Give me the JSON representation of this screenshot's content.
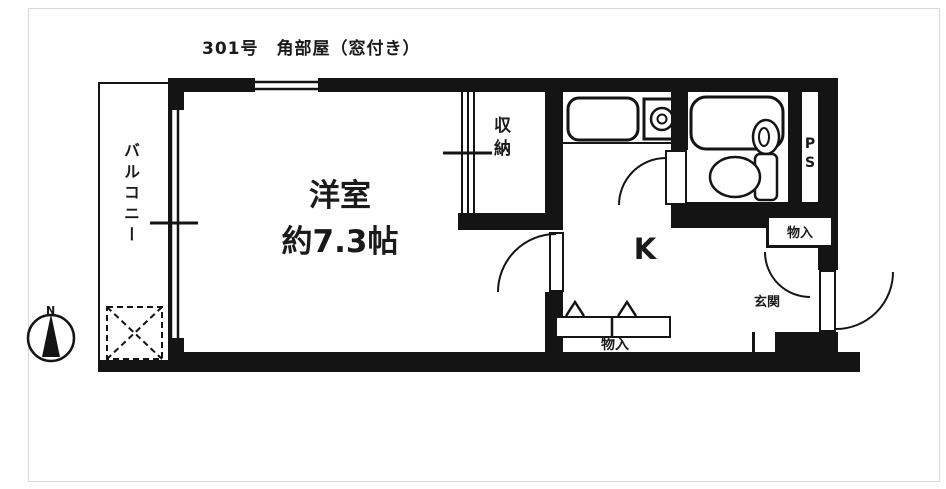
{
  "title": "301号　角部屋（窓付き）",
  "compass": {
    "north": "N"
  },
  "labels": {
    "balcony": "バルコニー",
    "room_name": "洋室",
    "room_size": "約7.3帖",
    "closet": "収納",
    "kitchen": "K",
    "pipe_space": "PS",
    "storage_right": "物入",
    "storage_bottom": "物入",
    "entrance": "玄関"
  },
  "colors": {
    "wall": "#141414",
    "background": "#ffffff"
  }
}
